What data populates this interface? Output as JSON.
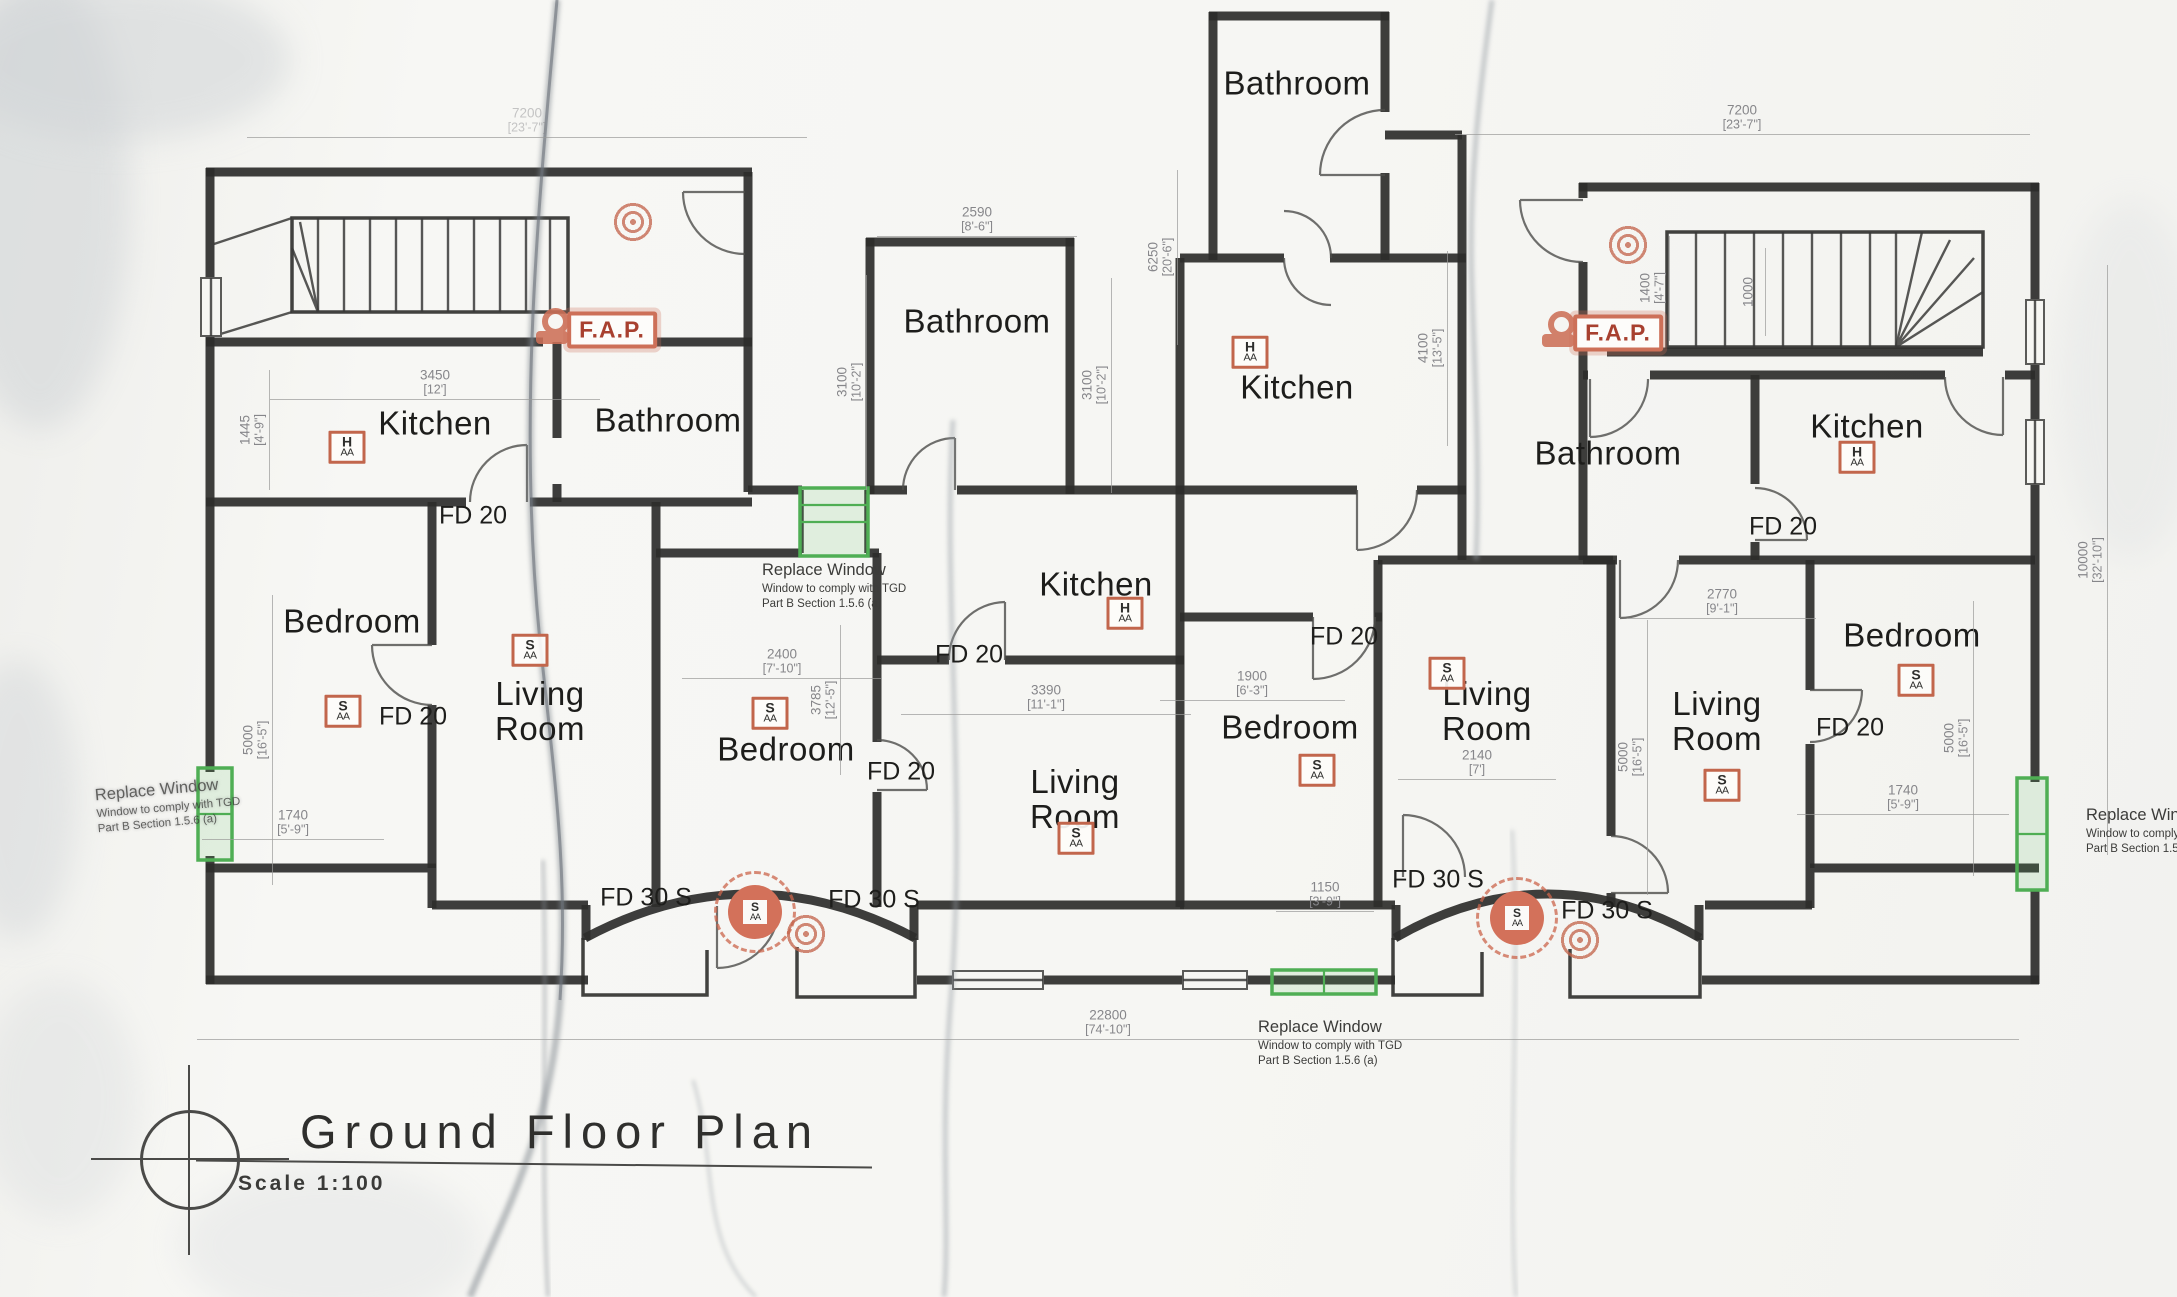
{
  "page": {
    "width": 2177,
    "height": 1297,
    "paper_color": "#f6f6f3"
  },
  "title": {
    "text": "Ground Floor Plan",
    "scale": "Scale 1:100"
  },
  "colors": {
    "wall_ink": "#2d2d2b",
    "dimension_gray": "#86868a",
    "window_green": "#4fae54",
    "fire_red": "#cd7058",
    "label_ink": "#1d1d1b"
  },
  "room_labels": [
    {
      "text": "Kitchen",
      "x": 435,
      "y": 424
    },
    {
      "text": "Bathroom",
      "x": 668,
      "y": 421
    },
    {
      "text": "Bedroom",
      "x": 352,
      "y": 622
    },
    {
      "text": "Living\nRoom",
      "x": 540,
      "y": 712
    },
    {
      "text": "Bathroom",
      "x": 977,
      "y": 322
    },
    {
      "text": "Kitchen",
      "x": 1096,
      "y": 585
    },
    {
      "text": "Bedroom",
      "x": 786,
      "y": 750
    },
    {
      "text": "Living\nRoom",
      "x": 1075,
      "y": 800
    },
    {
      "text": "Bathroom",
      "x": 1297,
      "y": 84
    },
    {
      "text": "Kitchen",
      "x": 1297,
      "y": 388
    },
    {
      "text": "Bedroom",
      "x": 1290,
      "y": 728
    },
    {
      "text": "Living\nRoom",
      "x": 1487,
      "y": 712
    },
    {
      "text": "Bathroom",
      "x": 1608,
      "y": 454
    },
    {
      "text": "Kitchen",
      "x": 1867,
      "y": 427
    },
    {
      "text": "Bedroom",
      "x": 1912,
      "y": 636
    },
    {
      "text": "Living\nRoom",
      "x": 1717,
      "y": 722
    }
  ],
  "fire_door_labels": [
    {
      "text": "FD 20",
      "x": 473,
      "y": 516
    },
    {
      "text": "FD 20",
      "x": 413,
      "y": 717
    },
    {
      "text": "FD 20",
      "x": 969,
      "y": 655
    },
    {
      "text": "FD 20",
      "x": 901,
      "y": 772
    },
    {
      "text": "FD 20",
      "x": 1344,
      "y": 637
    },
    {
      "text": "FD 20",
      "x": 1783,
      "y": 527
    },
    {
      "text": "FD 20",
      "x": 1850,
      "y": 728
    },
    {
      "text": "FD 30 S",
      "x": 646,
      "y": 898
    },
    {
      "text": "FD 30 S",
      "x": 874,
      "y": 900
    },
    {
      "text": "FD 30 S",
      "x": 1438,
      "y": 880
    },
    {
      "text": "FD 30 S",
      "x": 1607,
      "y": 911
    }
  ],
  "fire_alarm_panels": [
    {
      "text": "F.A.P.",
      "x": 612,
      "y": 330
    },
    {
      "text": "F.A.P.",
      "x": 1618,
      "y": 333
    }
  ],
  "bell_icons": [
    {
      "x": 556,
      "y": 326
    },
    {
      "x": 1562,
      "y": 329
    }
  ],
  "alarm_markers": [
    {
      "type": "smoke",
      "top": "S",
      "bottom": "AA",
      "x": 343,
      "y": 711
    },
    {
      "type": "smoke",
      "top": "S",
      "bottom": "AA",
      "x": 530,
      "y": 650
    },
    {
      "type": "smoke",
      "top": "S",
      "bottom": "AA",
      "x": 770,
      "y": 713
    },
    {
      "type": "smoke",
      "top": "S",
      "bottom": "AA",
      "x": 1076,
      "y": 838
    },
    {
      "type": "smoke",
      "top": "S",
      "bottom": "AA",
      "x": 1317,
      "y": 770
    },
    {
      "type": "smoke",
      "top": "S",
      "bottom": "AA",
      "x": 1447,
      "y": 673
    },
    {
      "type": "smoke",
      "top": "S",
      "bottom": "AA",
      "x": 1722,
      "y": 785
    },
    {
      "type": "smoke",
      "top": "S",
      "bottom": "AA",
      "x": 1916,
      "y": 680
    },
    {
      "type": "heat",
      "top": "H",
      "bottom": "AA",
      "x": 347,
      "y": 447
    },
    {
      "type": "heat",
      "top": "H",
      "bottom": "AA",
      "x": 1125,
      "y": 613
    },
    {
      "type": "heat",
      "top": "H",
      "bottom": "AA",
      "x": 1250,
      "y": 352
    },
    {
      "type": "heat",
      "top": "H",
      "bottom": "AA",
      "x": 1857,
      "y": 457
    }
  ],
  "highlighted_alarms": [
    {
      "top": "S",
      "bottom": "AA",
      "x": 755,
      "y": 912
    },
    {
      "top": "S",
      "bottom": "AA",
      "x": 1517,
      "y": 918
    }
  ],
  "sounder_icons": [
    {
      "x": 633,
      "y": 222
    },
    {
      "x": 1628,
      "y": 245
    },
    {
      "x": 806,
      "y": 934
    },
    {
      "x": 1580,
      "y": 940
    }
  ],
  "dimensions_h": [
    {
      "value": "7200",
      "imperial": "[23'-7\"]",
      "x": 527,
      "y": 120,
      "lw": 560,
      "faint": true
    },
    {
      "value": "7200",
      "imperial": "[23'-7\"]",
      "x": 1742,
      "y": 117,
      "lw": 575
    },
    {
      "value": "3450",
      "imperial": "[12']",
      "x": 435,
      "y": 382,
      "lw": 330
    },
    {
      "value": "2590",
      "imperial": "[8'-6\"]",
      "x": 977,
      "y": 219,
      "lw": 200
    },
    {
      "value": "2400",
      "imperial": "[7'-10\"]",
      "x": 782,
      "y": 661,
      "lw": 200
    },
    {
      "value": "3390",
      "imperial": "[11'-1\"]",
      "x": 1046,
      "y": 697,
      "lw": 290
    },
    {
      "value": "1900",
      "imperial": "[6'-3\"]",
      "x": 1252,
      "y": 683,
      "lw": 185
    },
    {
      "value": "2140",
      "imperial": "[7']",
      "x": 1477,
      "y": 762,
      "lw": 158
    },
    {
      "value": "2770",
      "imperial": "[9'-1\"]",
      "x": 1722,
      "y": 601,
      "lw": 188
    },
    {
      "value": "1740",
      "imperial": "[5'-9\"]",
      "x": 293,
      "y": 822,
      "lw": 182
    },
    {
      "value": "1740",
      "imperial": "[5'-9\"]",
      "x": 1903,
      "y": 797,
      "lw": 212
    },
    {
      "value": "1150",
      "imperial": "[3'-9\"]",
      "x": 1325,
      "y": 894,
      "lw": 98
    },
    {
      "value": "22800",
      "imperial": "[74'-10\"]",
      "x": 1108,
      "y": 1022,
      "lw": 1822
    }
  ],
  "dimensions_v": [
    {
      "value": "1445",
      "imperial": "[4'-9\"]",
      "x": 252,
      "y": 430,
      "lh": 120
    },
    {
      "value": "5000",
      "imperial": "[16'-5\"]",
      "x": 255,
      "y": 740,
      "lh": 290
    },
    {
      "value": "3100",
      "imperial": "[10'-2\"]",
      "x": 849,
      "y": 382,
      "lh": 215
    },
    {
      "value": "3100",
      "imperial": "[10'-2\"]",
      "x": 1094,
      "y": 385,
      "lh": 215
    },
    {
      "value": "6250",
      "imperial": "[20'-6\"]",
      "x": 1160,
      "y": 257,
      "lh": 175
    },
    {
      "value": "4100",
      "imperial": "[13'-5\"]",
      "x": 1430,
      "y": 348,
      "lh": 195
    },
    {
      "value": "3785",
      "imperial": "[12'-5\"]",
      "x": 823,
      "y": 700,
      "lh": 150
    },
    {
      "value": "5000",
      "imperial": "[16'-5\"]",
      "x": 1630,
      "y": 757,
      "lh": 275
    },
    {
      "value": "1400",
      "imperial": "[4'-7\"]",
      "x": 1652,
      "y": 288,
      "lh": 105
    },
    {
      "value": "1000",
      "imperial": "",
      "x": 1748,
      "y": 292,
      "lh": 88
    },
    {
      "value": "5000",
      "imperial": "[16'-5\"]",
      "x": 1956,
      "y": 738,
      "lh": 275
    },
    {
      "value": "10000",
      "imperial": "[32'-10\"]",
      "x": 2090,
      "y": 560,
      "lh": 590
    }
  ],
  "annotations": [
    {
      "l1": "Replace Window",
      "l2": "Window to comply with TGD",
      "l3": "Part B Section 1.5.6 (a)",
      "x": 96,
      "y": 778,
      "rot": -5,
      "smudged": true
    },
    {
      "l1": "Replace Window",
      "l2": "Window to comply with TGD",
      "l3": "Part B Section 1.5.6 (a)",
      "x": 762,
      "y": 561,
      "rot": 0,
      "smudged": false
    },
    {
      "l1": "Replace Window",
      "l2": "Window to comply with TGD",
      "l3": "Part B Section 1.5.6 (a)",
      "x": 1258,
      "y": 1018,
      "rot": 0,
      "smudged": false
    },
    {
      "l1": "Replace Window",
      "l2": "Window to comply with TGD",
      "l3": "Part B Section 1.5.6 (a)",
      "x": 2086,
      "y": 806,
      "rot": 0,
      "smudged": false
    }
  ]
}
